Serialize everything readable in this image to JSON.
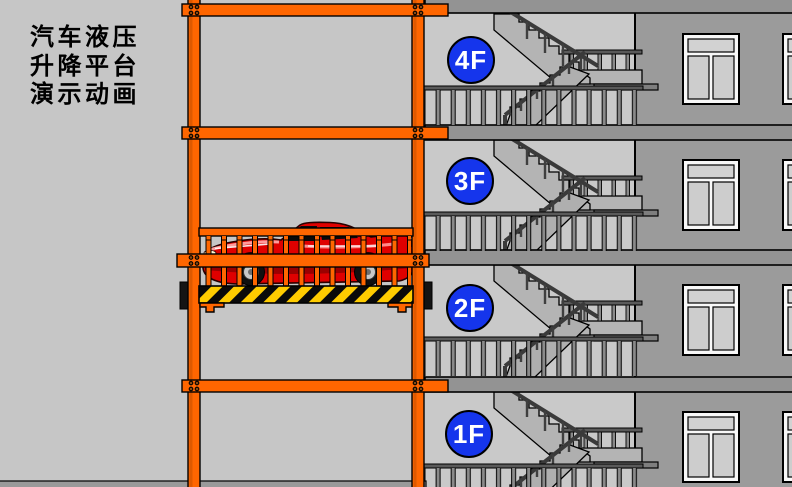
{
  "title": {
    "lines": [
      "汽车液压",
      "升降平台",
      "演示动画"
    ]
  },
  "floors": [
    {
      "label": "4F"
    },
    {
      "label": "3F"
    },
    {
      "label": "2F"
    },
    {
      "label": "1F"
    }
  ],
  "colors": {
    "bg": "#C6C6C6",
    "stair-bg": "#C9C9C9",
    "wall": "#9B9B9B",
    "slab": "#939393",
    "frame-orange": "#FF6600",
    "floor-blue": "#1535EC",
    "hazard-yellow": "#FFCC00",
    "car-red": "#DF0000"
  }
}
